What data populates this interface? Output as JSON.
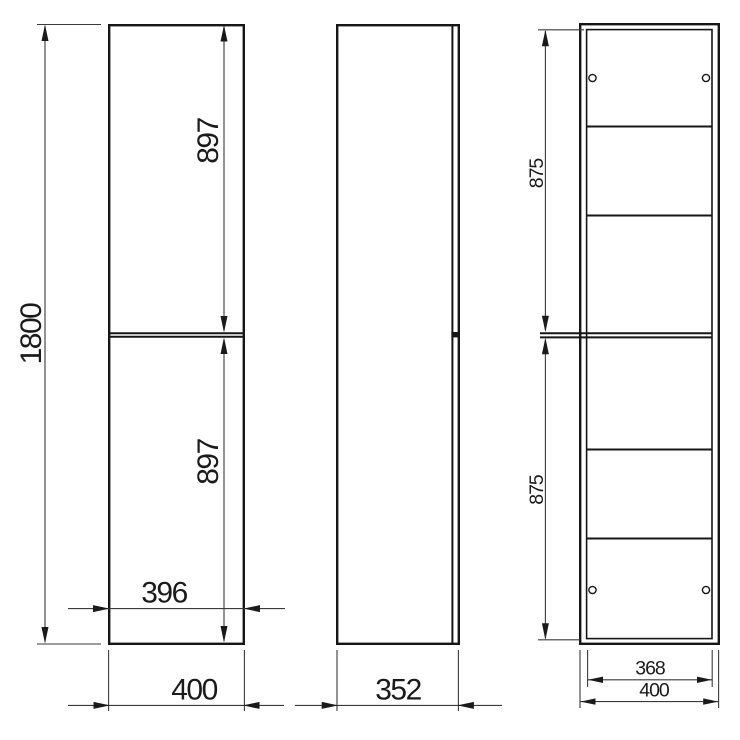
{
  "drawing": {
    "front": {
      "overall_height": "1800",
      "upper_door_height": "897",
      "lower_door_height": "897",
      "door_width": "396",
      "overall_width": "400"
    },
    "side": {
      "overall_depth": "352"
    },
    "section": {
      "upper_cavity_height": "875",
      "lower_cavity_height": "875",
      "interior_width": "368",
      "overall_width": "400"
    },
    "colors": {
      "line": "#161616",
      "dimension_line": "#3a3a3a",
      "text": "#1a1a1a",
      "background": "#ffffff"
    }
  }
}
